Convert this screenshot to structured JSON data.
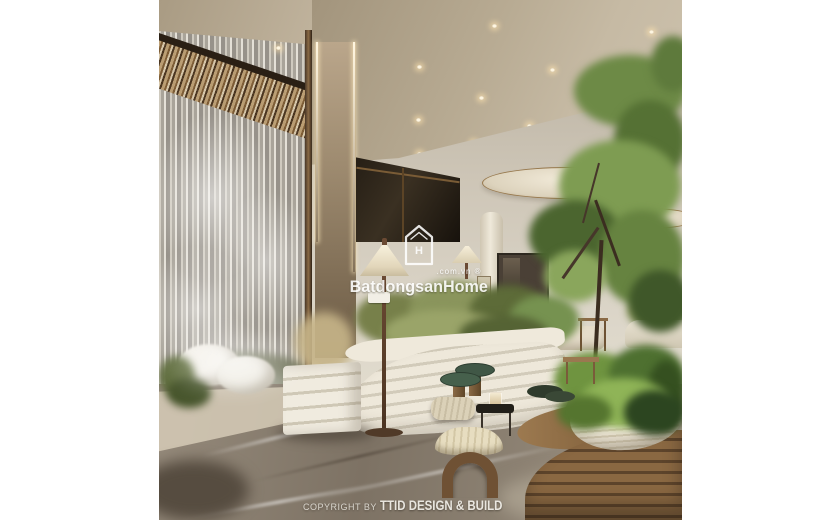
{
  "image": {
    "type": "architectural-interior-render",
    "description": "Luxury lobby lounge: glass waterfall wall, bronze lit pillar, disc pendant lights, indoor trees and planters, curved white slatted garden beds, floor lamp, stools and a round wooden bench with a rattan plant bowl on grey marble flooring"
  },
  "watermark": {
    "logo_letter": "H",
    "domain": ".com.vn ®",
    "brand": "BatdongsanHome"
  },
  "footer": {
    "copyright_prefix": "COPYRIGHT BY ",
    "studio": "TTID DESIGN & BUILD"
  },
  "palette": {
    "ceiling_tan": "#b3a58c",
    "wall_beige": "#d6d0c3",
    "wood": "#7c5c38",
    "foliage": "#5e7a3c",
    "marble": "#857a6c",
    "watermark_white": "#ffffff"
  }
}
